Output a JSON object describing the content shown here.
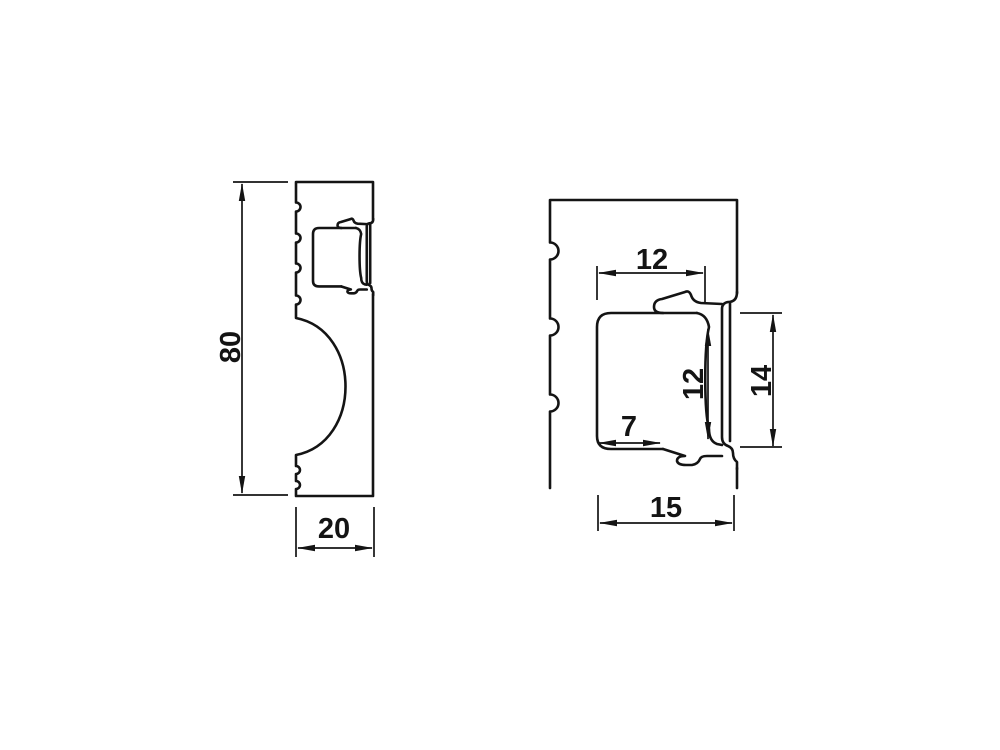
{
  "colors": {
    "line": "#141414",
    "background": "#ffffff"
  },
  "left_view": {
    "height_label": "80",
    "width_label": "20"
  },
  "detail_view": {
    "top_width_label": "12",
    "inner_height_label": "12",
    "overall_height_label": "14",
    "bottom_width_label": "7",
    "overall_width_label": "15"
  }
}
